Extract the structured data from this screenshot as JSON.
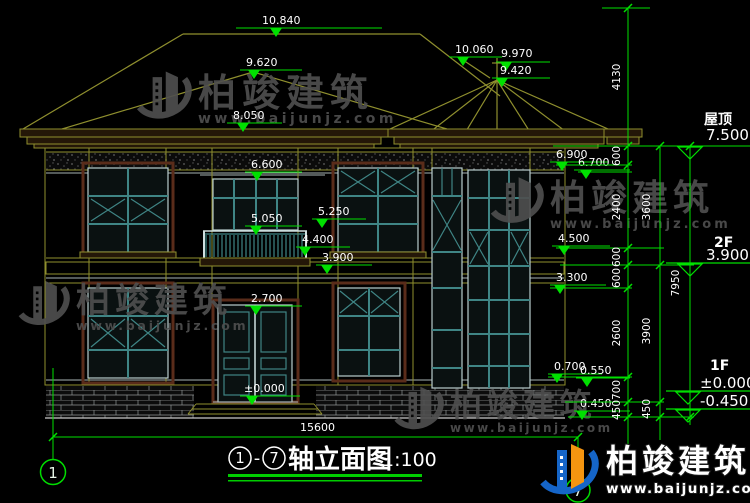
{
  "drawing": {
    "scale_note": "1:100",
    "title_name": "轴立面图",
    "title_axis_from": "1",
    "title_axis_to": "7",
    "title_dash": "-"
  },
  "axis_bubbles": {
    "left": "1",
    "right": "7"
  },
  "dims": {
    "overall_width": "15600",
    "top_height": "4130",
    "col_inner": [
      "600",
      "2400",
      "600",
      "600",
      "2600",
      "700",
      "450"
    ],
    "col_mid": [
      "3600",
      "3900",
      "450"
    ],
    "col_outer": [
      "7950"
    ]
  },
  "levels": {
    "roof_label": "屋顶",
    "roof_value": "7.500",
    "f2_label": "2F",
    "f2_value": "3.900",
    "f1_label": "1F",
    "f1_value": "±0.000",
    "base_value": "-0.450"
  },
  "marks": [
    "10.840",
    "9.620",
    "10.060",
    "9.970",
    "9.420",
    "8.050",
    "6.600",
    "6.900",
    "6.700",
    "5.050",
    "5.250",
    "4.400",
    "3.900",
    "4.500",
    "3.300",
    "2.700",
    "±0.000",
    "0.700",
    "0.550",
    "0.450"
  ],
  "watermark": {
    "brand": "柏竣建筑",
    "url": "www.baijunjz.com"
  },
  "colors": {
    "dim_green": "#00e000",
    "linework_olive": "#8f8f2e",
    "window_teal": "#3f8585",
    "frame_maroon": "#5a2c1a",
    "watermark_gray": "#4f4f4f",
    "logo_blue": "#1565c8",
    "logo_orange": "#f59510"
  }
}
